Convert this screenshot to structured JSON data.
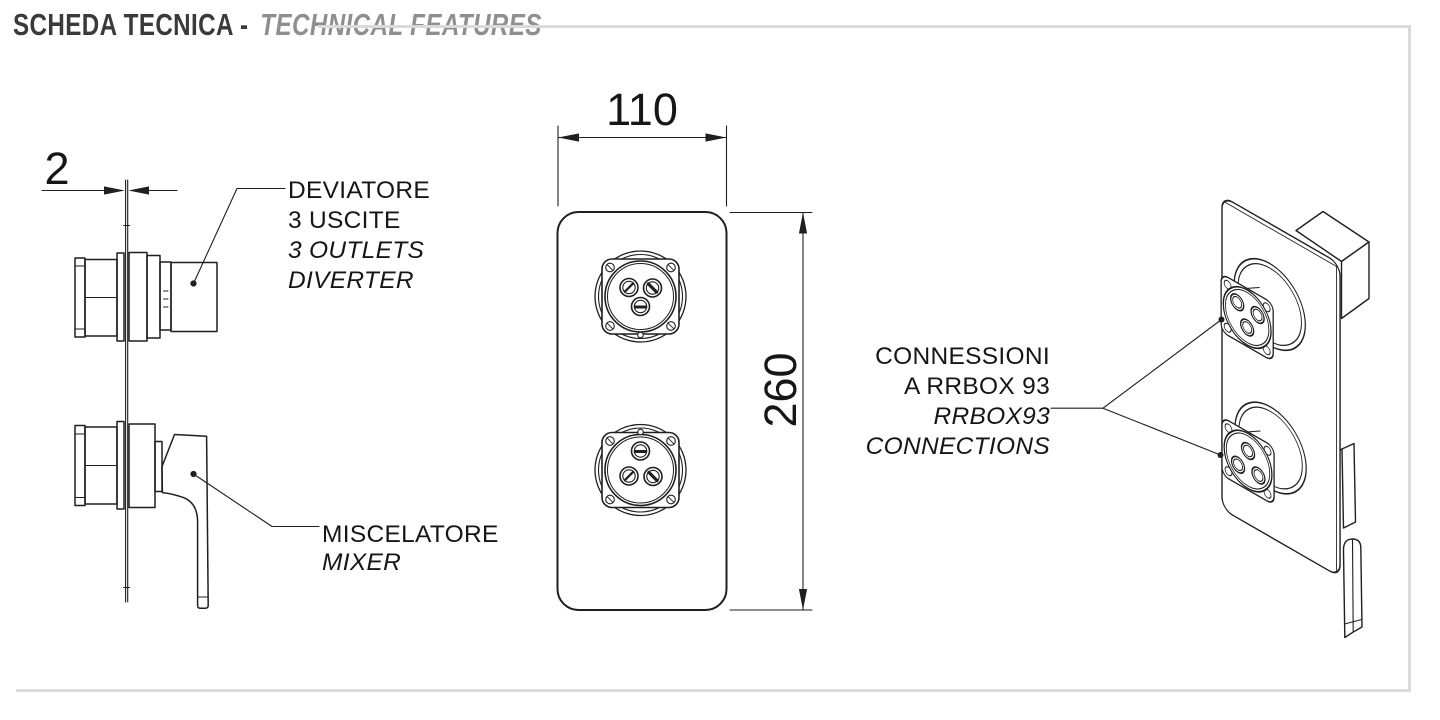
{
  "header": {
    "title_primary": "SCHEDA TECNICA -",
    "title_secondary": "TECHNICAL FEATURES"
  },
  "dimensions": {
    "plate_thickness": "2",
    "plate_width": "110",
    "plate_height": "260"
  },
  "labels": {
    "diverter": {
      "lines": [
        "DEVIATORE",
        "3 USCITE",
        "3 OUTLETS",
        "DIVERTER"
      ]
    },
    "mixer": {
      "lines": [
        "MISCELATORE",
        "MIXER"
      ]
    },
    "connections": {
      "lines": [
        "CONNESSIONI",
        "A RRBOX 93",
        "RRBOX93",
        "CONNECTIONS"
      ]
    }
  },
  "colors": {
    "line": "#1f1f1f",
    "frame_gray": "#dadadd",
    "title_primary": "#3a3a3c",
    "title_secondary": "#8f8f91"
  }
}
